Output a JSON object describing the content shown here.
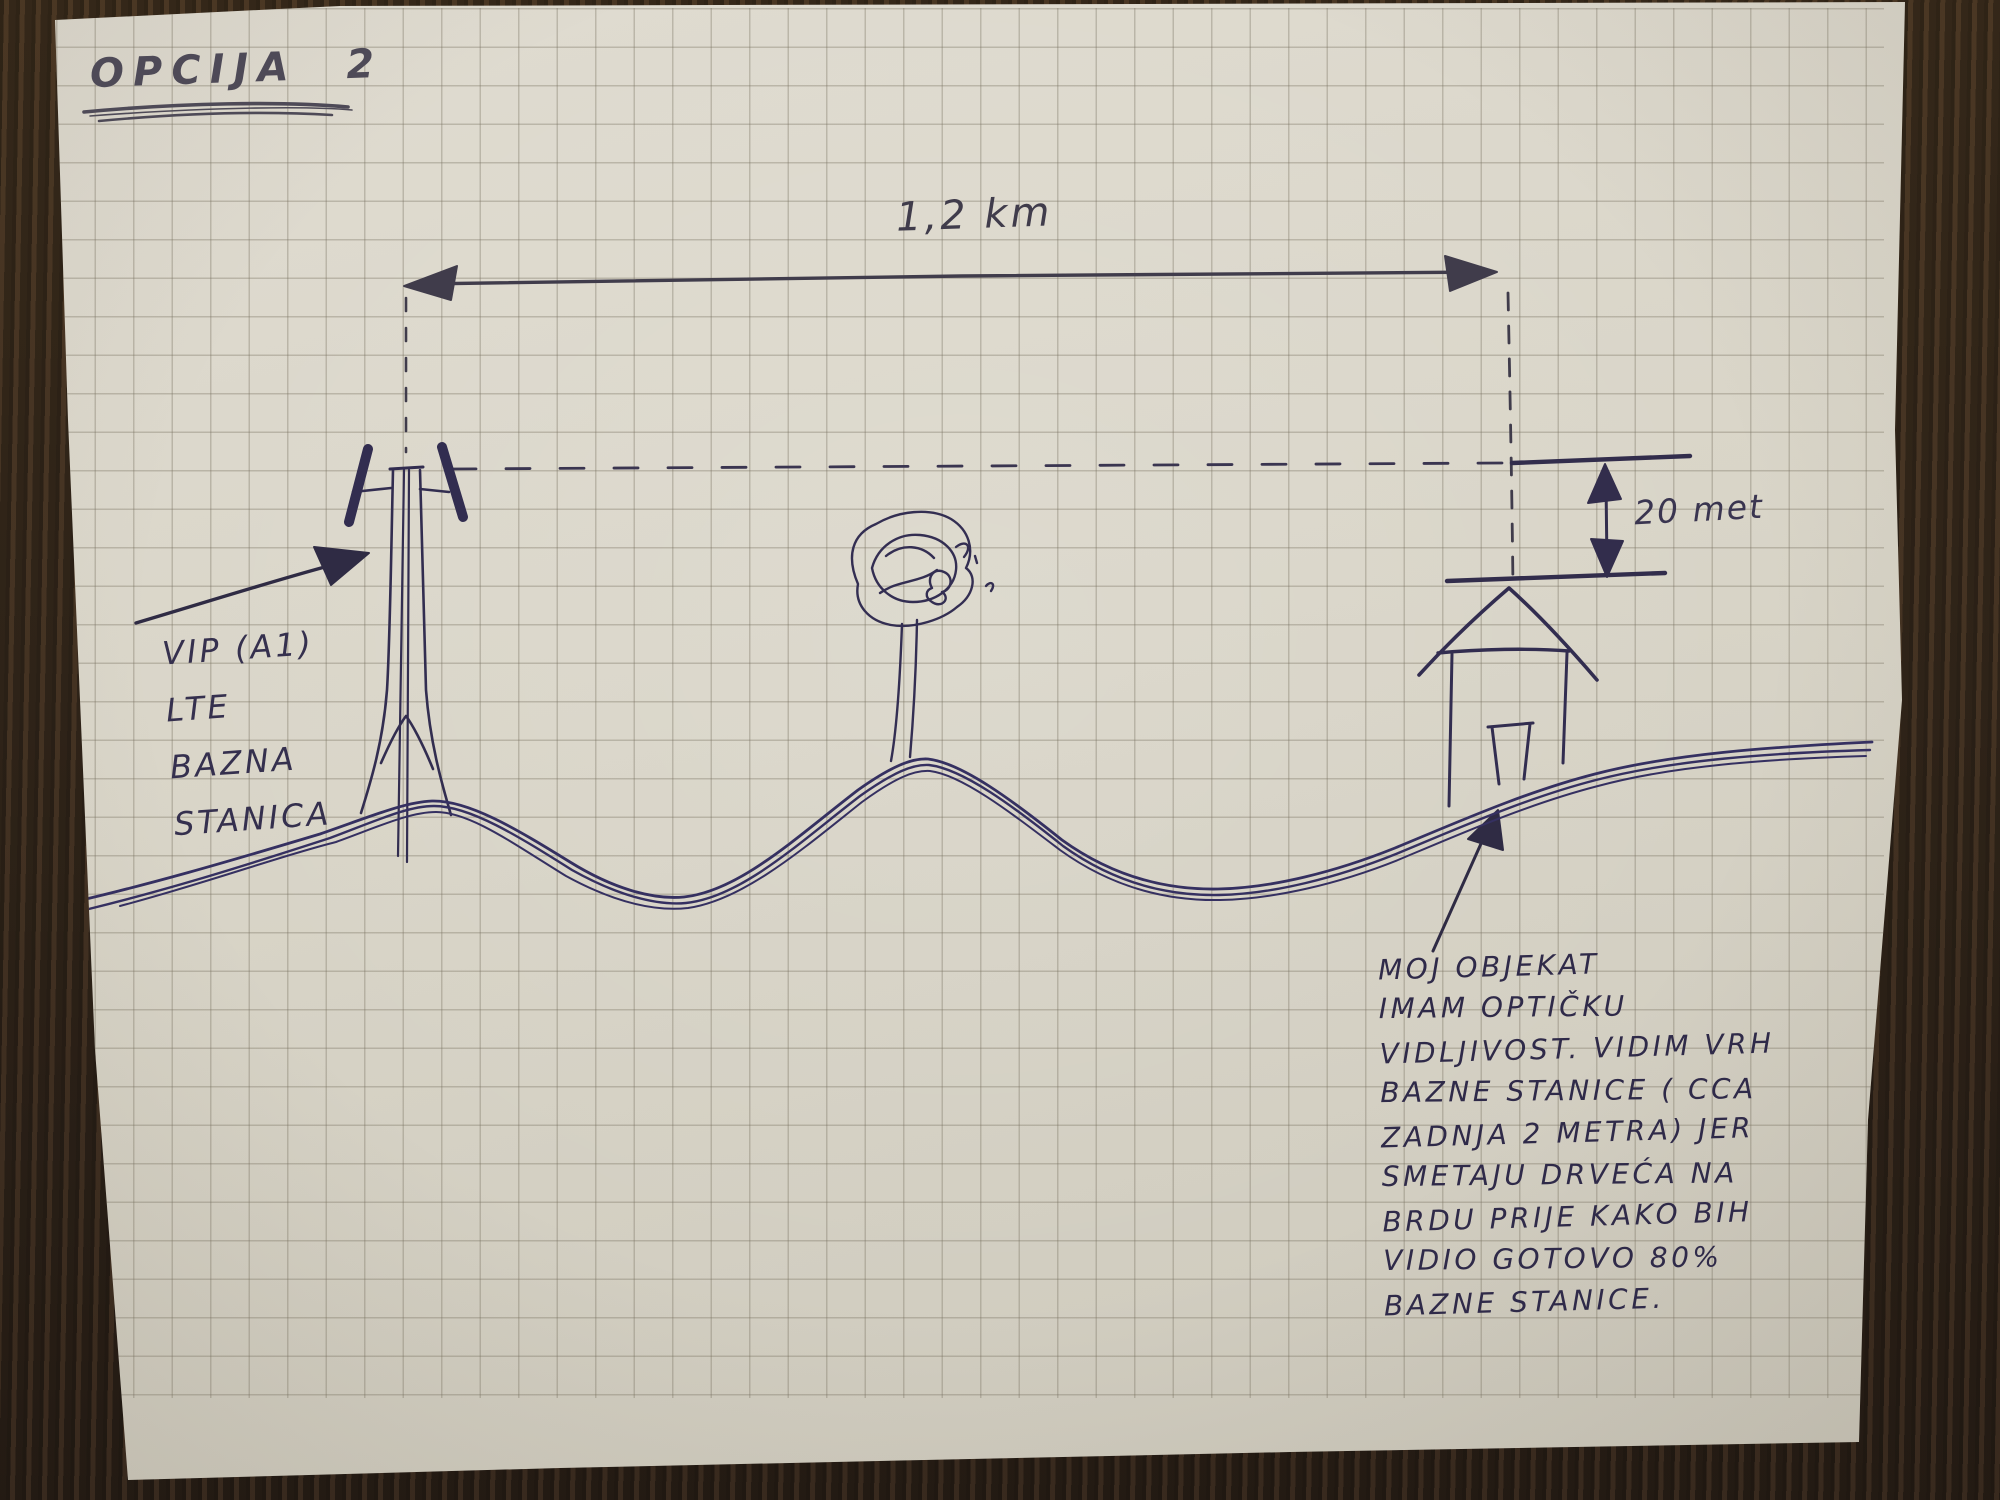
{
  "title": "OPCIJA 2",
  "dimension": {
    "distance_label": "1,2 km",
    "height_label": "20 met"
  },
  "tower_label": {
    "lines": [
      "VIP (A1)",
      "LTE",
      "BAZNA",
      "STANICA"
    ]
  },
  "note": {
    "lines": [
      "MOJ OBJEKAT",
      "IMAM OPTIČKU",
      "VIDLJIVOST. VIDIM VRH",
      "BAZNE STANICE ( CCA",
      "ZADNJA 2 METRA) JER",
      "SMETAJU DRVEĆA NA",
      "BRDU PRIJE KAKO BIH",
      "VIDIO GOTOVO 80%",
      "BAZNE STANICE."
    ]
  },
  "sketch_elements": [
    "lte-base-station-tower",
    "tree-on-hill",
    "house",
    "terrain-profile",
    "distance-dimension",
    "height-dimension"
  ],
  "colors": {
    "ink_blue": "#35304e",
    "ink_grey": "#45414f",
    "paper": "#d9d5c8",
    "grid_line": "#8d8674",
    "table_wood": "#3a2c1e"
  }
}
